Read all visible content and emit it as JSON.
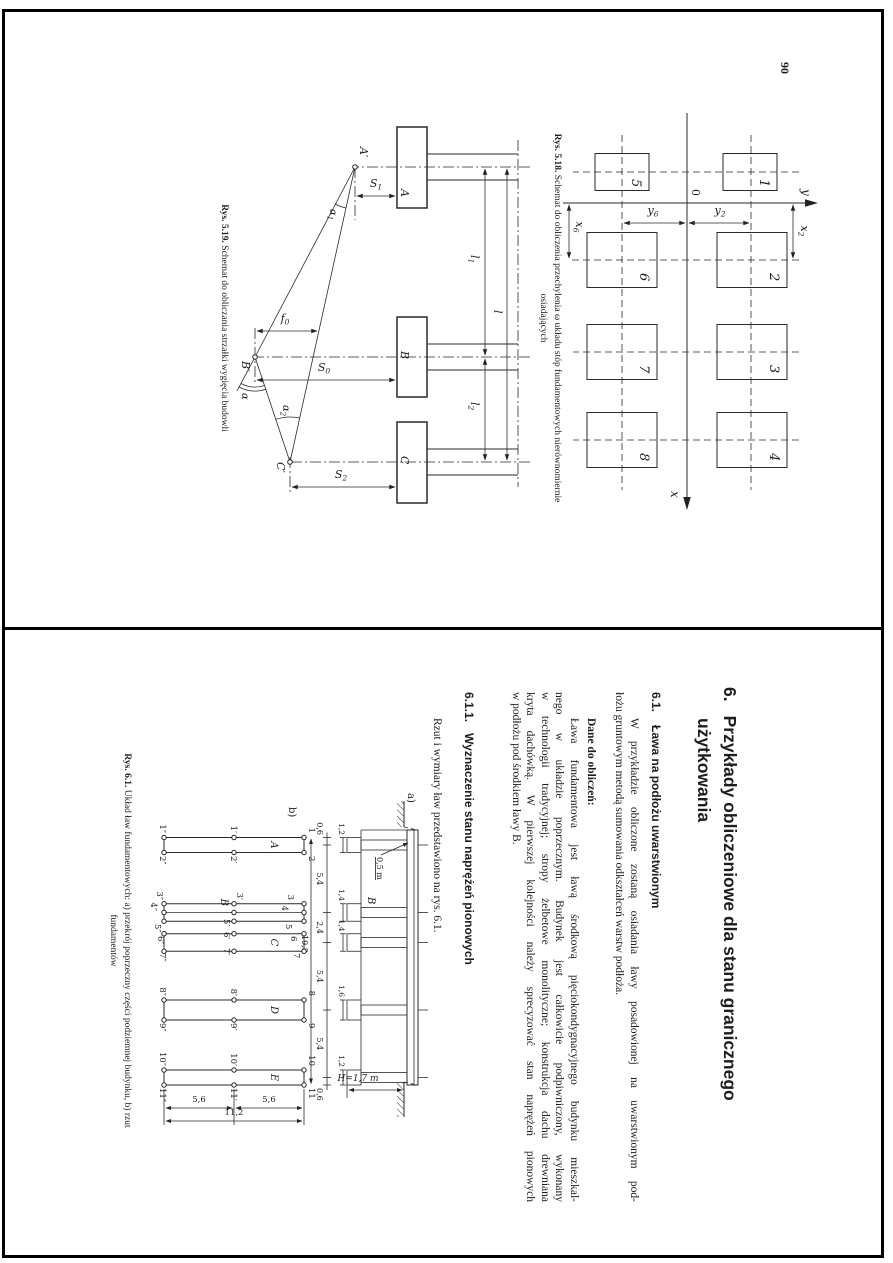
{
  "page_left": {
    "page_number": "90",
    "fig_5_18": {
      "origin_label": "0",
      "x_axis_label": "x",
      "y_axis_label": "y",
      "footing_numbers": [
        "1",
        "2",
        "3",
        "4",
        "5",
        "6",
        "7",
        "8"
      ],
      "dim_x2": {
        "base": "x",
        "sub": "2"
      },
      "dim_x6": {
        "base": "x",
        "sub": "6"
      },
      "dim_y2": {
        "base": "y",
        "sub": "2"
      },
      "dim_y6": {
        "base": "y",
        "sub": "6"
      },
      "caption": {
        "prefix": "Rys. 5.18.",
        "line1": "Schemat do obliczenia przechylenia ω układu stóp fundamentowych nierównomiernie",
        "line2": "osiadających"
      }
    },
    "fig_5_19": {
      "footing_labels": [
        "A",
        "B",
        "C"
      ],
      "point_labels": [
        "A′",
        "B′",
        "C′"
      ],
      "dim_l": "l",
      "dim_l1": {
        "base": "l",
        "sub": "1"
      },
      "dim_l2": {
        "base": "l",
        "sub": "2"
      },
      "dim_s1": {
        "base": "S",
        "sub": "1"
      },
      "dim_s0": {
        "base": "S",
        "sub": "0"
      },
      "dim_s2": {
        "base": "S",
        "sub": "2"
      },
      "dim_f0": {
        "base": "f",
        "sub": "0"
      },
      "angle_alpha": "α",
      "angle_alpha1": {
        "base": "α",
        "sub": "1"
      },
      "angle_alpha2": {
        "base": "α",
        "sub": "2"
      },
      "caption": {
        "prefix": "Rys. 5.19.",
        "text": "Schemat do obliczania strzałki wygięcia budowli"
      }
    }
  },
  "page_right": {
    "heading": {
      "number": "6.",
      "line1": "Przykłady obliczeniowe dla stanu granicznego",
      "line2": "użytkowania"
    },
    "section_6_1": {
      "number": "6.1.",
      "title": "Ława na podłożu uwarstwionym"
    },
    "para_intro_lines": [
      "W przykładzie obliczone zostaną osiadania ławy posadowionej na uwarstwionym pod-",
      "łożu gruntowym metodą sumowania odkształceń warstw podłoża."
    ],
    "dane_heading": "Dane do obliczeń:",
    "para_dane_lines": [
      "Ława fundamentowa jest ławą środkową pięciokondygnacyjnego budynku mieszkal-",
      "nego w układzie poprzecznym. Budynek jest całkowicie podpiwniczony, wykonany",
      "w technologii tradycyjnej; stropy żelbetowe monolityczne; konstrukcja dachu drewniana",
      "kryta dachówką. W pierwszej kolejności należy sprecyzować stan naprężeń pionowych",
      "w podłożu pod środkiem ławy B."
    ],
    "section_6_1_1": {
      "number": "6.1.1.",
      "title": "Wyznaczenie stanu naprężeń pionowych"
    },
    "para_rzut": "Rzut i wymiary ław przedstawiono na rys. 6.1.",
    "fig_6_1": {
      "label_a": "a)",
      "label_b": "b)",
      "label_half_m": "0,5 m",
      "label_wall_B": "B",
      "label_H": "H=1,7 m",
      "width_dims": [
        "1,2",
        "1,4",
        "1,4",
        "1,6",
        "1,2"
      ],
      "axis_dims": [
        "0,6",
        "5,4",
        "2,4",
        "5,4",
        "5,4",
        "0,6"
      ],
      "total_dim": "19,8",
      "plan": {
        "strip_letters": [
          "A",
          "B",
          "C",
          "D",
          "E"
        ],
        "top_labels": [
          "1",
          "2",
          "3",
          "4",
          "5",
          "6",
          "7",
          "8",
          "9",
          "10",
          "11"
        ],
        "mid_labels": [
          "1′",
          "2′",
          "3′",
          "5′",
          "6′",
          "7′",
          "8′",
          "9′",
          "10′",
          "11′"
        ],
        "bottom_labels": [
          "1″",
          "2″",
          "3″",
          "4″",
          "5″",
          "6″",
          "7″",
          "8″",
          "9″",
          "10″",
          "11″"
        ],
        "len_dims": [
          "5,6",
          "5,6"
        ],
        "len_total": "11,2"
      },
      "caption": {
        "prefix": "Rys. 6.1.",
        "line1": "Układ ław fundamentowych: a) przekrój poprzeczny części podziemnej budynku, b) rzut",
        "line2": "fundamentów"
      }
    }
  }
}
